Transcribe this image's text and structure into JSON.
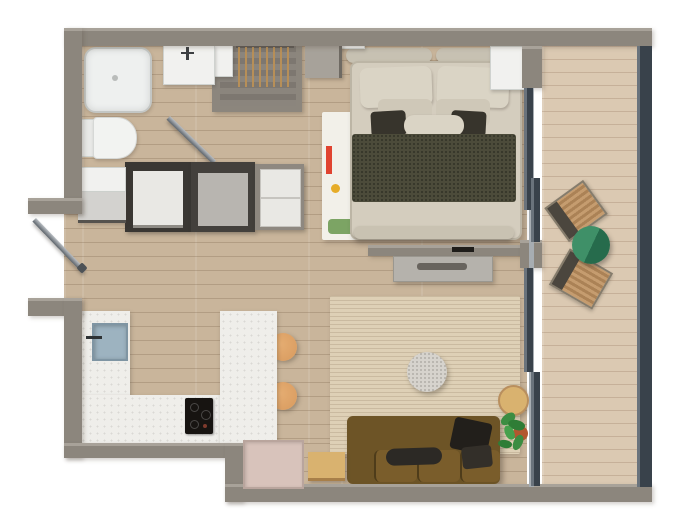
{
  "meta": {
    "title": "Studio apartment 3D top-down floor plan",
    "view": "top-down render",
    "canvas": {
      "width_px": 680,
      "height_px": 532
    },
    "visible_text": "none"
  },
  "palette": {
    "wall": "#8c867d",
    "wall-light": "#a8a299",
    "floor": "#c9b59b",
    "balcony-floor": "#dbc9b2",
    "glass": "#39424b",
    "glass-frame": "#a7adb2",
    "fixture-white": "#f1f1ef",
    "fixture-border": "#cfd2cf",
    "counter": "#efeeea",
    "sink": "#9db3c0",
    "cooktop": "#171411",
    "stool": "#d89a5e",
    "wood-table": "#d9b26f",
    "rug-living": "#ded0b6",
    "rug-bed": "#f2f0e9",
    "sofa": "#6d5426",
    "sofa-seat": "#7a5d2b",
    "pillow-dark": "#2c2925",
    "duvet": "#d4cdbe",
    "pillow": "#dad4c5",
    "pillow-mid": "#cfc8b8",
    "blanket": "#4c4b3a",
    "headboard": "#c7c1b2",
    "unit-dark": "#3a3733",
    "unit-front": "#e9e8e4",
    "unit-gray": "#b8b5b0",
    "cabinet-pink": "#d8c3bb",
    "plant": "#3c8d42",
    "pot": "#b2572f",
    "table-green": "#3f9068",
    "table-green-dark": "#266b4c",
    "rattan": "#c59c6f",
    "rattan-dark": "#4b463e",
    "accent-red": "#e04330",
    "accent-teal": "#2aa19a",
    "accent-yellow": "#e6ac28",
    "accent-green": "#86a96a",
    "pouf": "#d6d3cd",
    "steel": "#b9bec3",
    "steel-dark": "#5d646b",
    "tv": "#1f1d1a",
    "console": "#b5b2ac"
  },
  "rooms": [
    {
      "id": "bathroom",
      "area": "top-left",
      "objects": [
        "shower-tray",
        "toilet",
        "sink-vanity",
        "glass-door-open"
      ]
    },
    {
      "id": "hallway",
      "area": "left",
      "objects": [
        "entry-door-open",
        "open-wardrobe-with-hangers",
        "dresser",
        "washer-unit",
        "gray-appliance-unit",
        "drawer-unit",
        "white-shelf",
        "gray-cabinet"
      ]
    },
    {
      "id": "bedroom",
      "area": "top-center",
      "objects": [
        "double-bed",
        "headboard-cushions",
        "pillows",
        "olive-throw-blanket",
        "white-graphic-rug",
        "nightstand",
        "wall-shelf"
      ]
    },
    {
      "id": "media-partition",
      "area": "center",
      "objects": [
        "tv-rail",
        "tv-console"
      ]
    },
    {
      "id": "kitchen",
      "area": "bottom-left",
      "objects": [
        "u-shaped-counter",
        "kitchen-sink",
        "cooktop",
        "bar-stool",
        "bar-stool"
      ]
    },
    {
      "id": "living-room",
      "area": "bottom-center",
      "objects": [
        "striped-rug",
        "round-pouf",
        "brown-sofa",
        "dark-cushions",
        "square-side-table",
        "round-side-table",
        "potted-plant",
        "recessed-cabinet"
      ]
    },
    {
      "id": "balcony",
      "area": "right",
      "objects": [
        "sliding-glass-doors",
        "glass-balustrade",
        "rattan-chair",
        "rattan-chair",
        "green-bistro-table"
      ]
    }
  ]
}
